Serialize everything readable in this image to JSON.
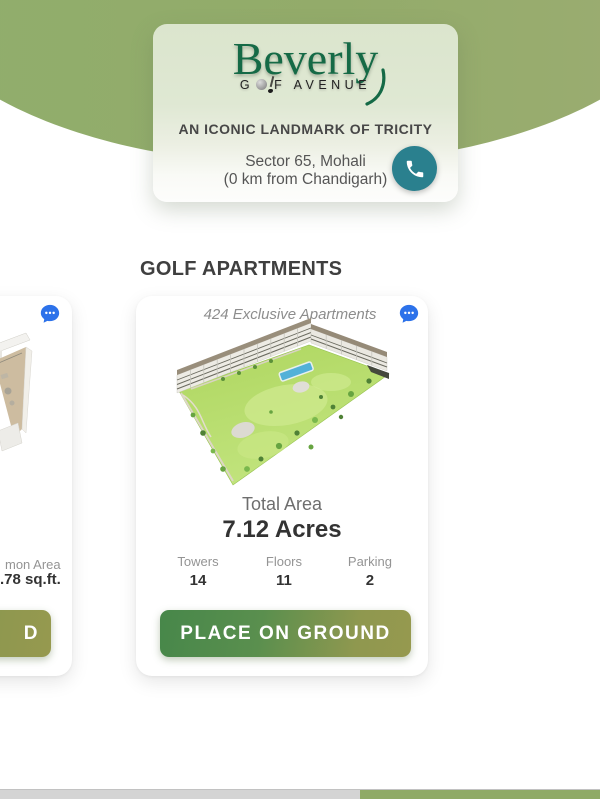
{
  "header": {
    "logo": {
      "brand": "Beverly",
      "word_g": "G",
      "word_rest": "F AVENUE",
      "ball_icon": "golf-ball-icon",
      "club_icon": "golf-club-icon"
    },
    "tagline": "AN ICONIC LANDMARK OF TRICITY",
    "location_line1": "Sector 65, Mohali",
    "location_line2": "(0 km from Chandigarh)",
    "phone_icon": "phone-icon"
  },
  "section": {
    "heading": "GOLF APARTMENTS"
  },
  "main_card": {
    "title": "424 Exclusive Apartments",
    "chat_icon": "chat-bubble-icon",
    "image": "apartment-site-plan-3d",
    "total_area_label": "Total Area",
    "total_area_value": "7.12 Acres",
    "stats": [
      {
        "label": "Towers",
        "value": "14"
      },
      {
        "label": "Floors",
        "value": "11"
      },
      {
        "label": "Parking",
        "value": "2"
      }
    ],
    "cta_label": "PLACE ON GROUND"
  },
  "left_card": {
    "chat_icon": "chat-bubble-icon",
    "image": "apartment-floorplan-3d",
    "stat_label_fragment": "mon Area",
    "stat_value_fragment": ".78 sq.ft.",
    "cta_label_fragment": "D"
  },
  "carousel_scrollbar": {
    "track_color": "#d4d4d4",
    "thumb_color": "#8faa66",
    "thumb_start_fraction": 0.6
  },
  "colors": {
    "logo_green": "#156a46",
    "arc_green": "#93ab6a",
    "phone_teal": "#2a808e",
    "chat_blue": "#2d72ea",
    "cta_gradient_start": "#47874a",
    "cta_gradient_end": "#96994f"
  }
}
